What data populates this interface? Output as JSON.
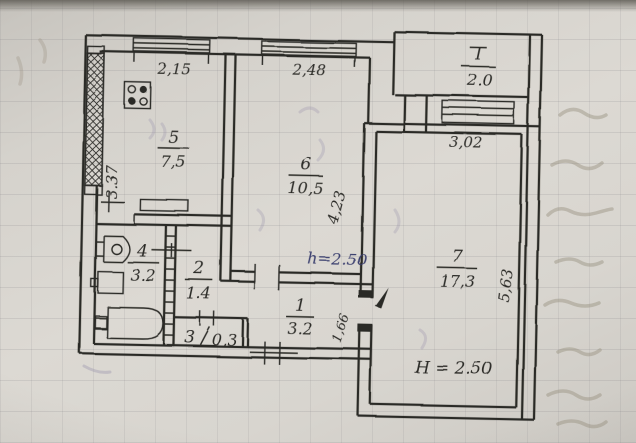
{
  "plan": {
    "rooms": {
      "balcony": {
        "number": "I",
        "area": "2.0"
      },
      "kitchen": {
        "number": "5",
        "area": "7,5"
      },
      "room6": {
        "number": "6",
        "area": "10,5"
      },
      "bathroom": {
        "number": "4",
        "area": "3.2"
      },
      "corridor": {
        "number": "2",
        "area": "1.4"
      },
      "closet": {
        "number": "3",
        "area": "0,3"
      },
      "hallway": {
        "number": "1",
        "area": "3.2"
      },
      "room7": {
        "number": "7",
        "area": "17,3"
      }
    },
    "dimensions": {
      "kitchen_window_width": "2,15",
      "room6_window_width": "2,48",
      "balcony_window_width": "3,02",
      "kitchen_wall_depth": "3.37",
      "room6_wall_depth": "4,23",
      "room7_door_width": "1,66",
      "room7_wall_depth": "5,63"
    },
    "ceiling_heights": {
      "room6": "h=2.50",
      "room7": "H = 2.50"
    }
  },
  "colors": {
    "ink": "#2b2a27",
    "blue_ink": "#383c6d",
    "paper": "#d6d3cd"
  }
}
